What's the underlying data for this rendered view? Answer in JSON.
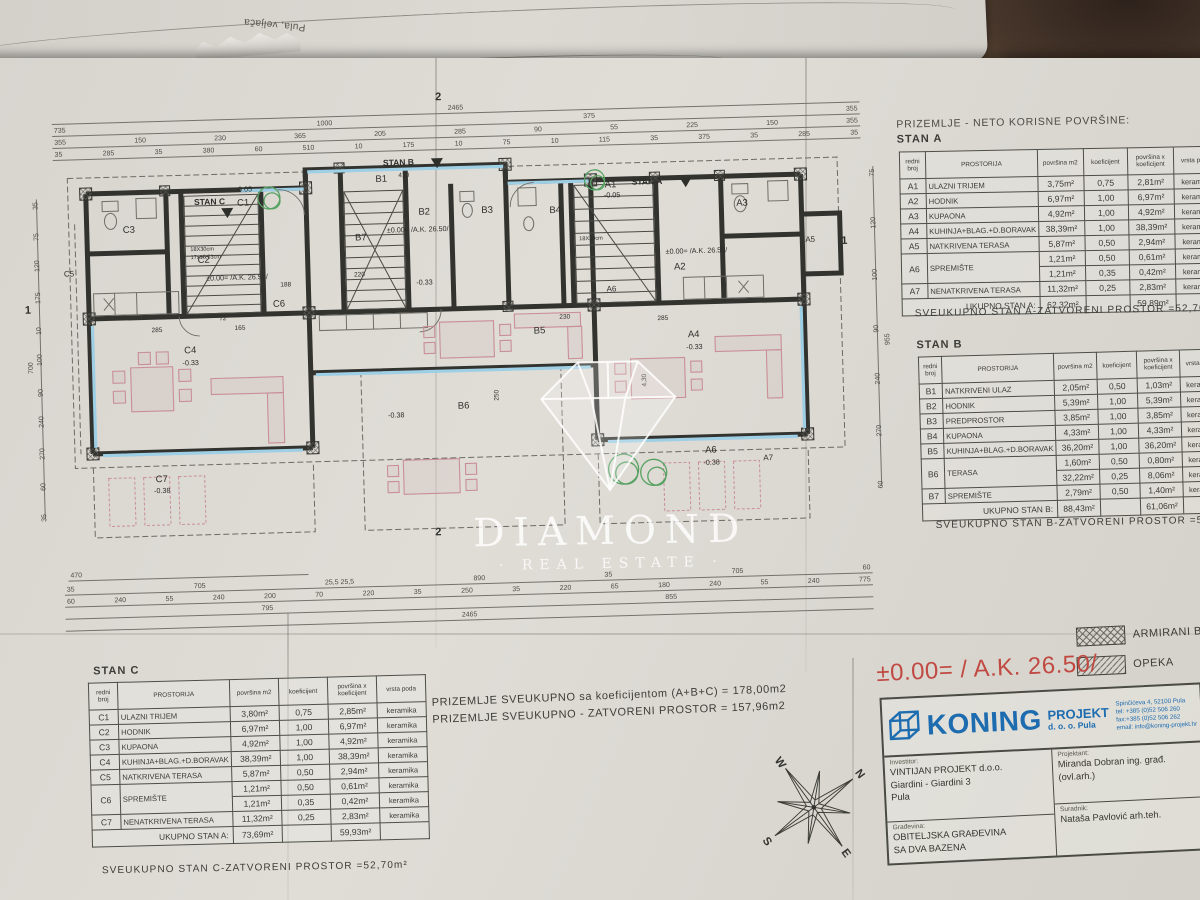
{
  "photo": {
    "back_sheet_note": "Pula, veljača"
  },
  "watermark": {
    "title": "DIAMOND",
    "subtitle": "· REAL ESTATE ·"
  },
  "plan": {
    "marker_top": "2",
    "marker_bottom": "2",
    "marker_left": "1",
    "marker_right": "1",
    "stan_a": "STAN A",
    "stan_b": "STAN B",
    "stan_c": "STAN C",
    "rooms": {
      "a1": "A1",
      "a2": "A2",
      "a3": "A3",
      "a4": "A4",
      "a5": "A5",
      "a6": "A6",
      "a6b": "A6",
      "a7": "A7",
      "b1": "B1",
      "b2": "B2",
      "b3": "B3",
      "b4": "B4",
      "b5": "B5",
      "b6": "B6",
      "b7": "B7",
      "c1": "C1",
      "c2": "C2",
      "c3": "C3",
      "c4": "C4",
      "c5": "C5",
      "c6": "C6",
      "c7": "C7"
    },
    "elev": {
      "zero": "±0.00= /A.K. 26.50/",
      "m005": "-0.05",
      "m033": "-0.33",
      "m038": "-0.38"
    },
    "stair_note": "18X30cm",
    "stair_note2": "17x15,53cm",
    "inline": {
      "d285a": "285",
      "d165": "165",
      "d230": "230",
      "d285b": "285",
      "d410": "410",
      "d220": "220",
      "d250": "250",
      "d430": "4,30",
      "d188": "188",
      "d72": "72"
    },
    "dims": {
      "top": [
        [
          "2465"
        ],
        [
          "735",
          "1000",
          "375",
          "355"
        ],
        [
          "355",
          "150",
          "230",
          "365",
          "205",
          "285",
          "90",
          "55",
          "225",
          "150",
          "355"
        ],
        [
          "35",
          "285",
          "35",
          "380",
          "60",
          "510",
          "10",
          "175",
          "10",
          "75",
          "10",
          "115",
          "35",
          "375",
          "35",
          "285",
          "35"
        ]
      ],
      "bottom": [
        [
          "470"
        ],
        [
          "35",
          "705",
          "25,5 25,5",
          "890",
          "35",
          "705",
          "60"
        ],
        [
          "60",
          "240",
          "55",
          "240",
          "200",
          "70",
          "220",
          "35",
          "250",
          "35",
          "220",
          "65",
          "180",
          "240",
          "55",
          "240",
          "775"
        ],
        [
          "795",
          "855"
        ],
        [
          "2465"
        ]
      ],
      "left": [
        "35",
        "75",
        "120",
        "175",
        "10",
        "100",
        "90",
        "240",
        "270",
        "60",
        "35"
      ],
      "left_outer": "700",
      "right": [
        "75",
        "120",
        "100",
        "90",
        "240",
        "270",
        "60"
      ],
      "right_outer": "955"
    }
  },
  "summary": {
    "line1": "PRIZEMLJE SVEUKUPNO sa koeficijentom (A+B+C) = 178,00m2",
    "line2": "PRIZEMLJE SVEUKUPNO - ZATVORENI PROSTOR = 157,96m2"
  },
  "tables": {
    "heading": "PRIZEMLJE - NETO KORISNE POVRŠINE:",
    "headers": [
      "redni broj",
      "PROSTORIJA",
      "površina m2",
      "koeficijent",
      "površina x koeficijent",
      "vrsta poda"
    ],
    "stan_a": {
      "title": "STAN A",
      "rows": [
        {
          "id": "A1",
          "name": "ULAZNI TRIJEM",
          "vals": [
            "3,75m²",
            "0,75",
            "2,81m²",
            "keramika"
          ]
        },
        {
          "id": "A2",
          "name": "HODNIK",
          "vals": [
            "6,97m²",
            "1,00",
            "6,97m²",
            "keramika"
          ]
        },
        {
          "id": "A3",
          "name": "KUPAONA",
          "vals": [
            "4,92m²",
            "1,00",
            "4,92m²",
            "keramika"
          ]
        },
        {
          "id": "A4",
          "name": "KUHINJA+BLAG.+D.BORAVAK",
          "vals": [
            "38,39m²",
            "1,00",
            "38,39m²",
            "keramika"
          ]
        },
        {
          "id": "A5",
          "name": "NATKRIVENA TERASA",
          "vals": [
            "5,87m²",
            "0,50",
            "2,94m²",
            "keramika"
          ]
        },
        {
          "id": "A6",
          "name": "SPREMIŠTE",
          "rs": 2,
          "vals": [
            "1,21m²",
            "0,50",
            "0,61m²",
            "keramika"
          ]
        },
        {
          "cont": true,
          "vals": [
            "1,21m²",
            "0,35",
            "0,42m²",
            "keramika"
          ]
        },
        {
          "id": "A7",
          "name": "NENATKRIVENA TERASA",
          "vals": [
            "11,32m²",
            "0,25",
            "2,83m²",
            "keramika"
          ]
        }
      ],
      "total_label": "UKUPNO STAN A:",
      "total_pov": "62,32m²",
      "total_povk": "59,89m²",
      "note": "SVEUKUPNO STAN A-ZATVORENI PROSTOR =52,70m²"
    },
    "stan_b": {
      "title": "STAN B",
      "rows": [
        {
          "id": "B1",
          "name": "NATKRIVENI ULAZ",
          "vals": [
            "2,05m²",
            "0,50",
            "1,03m²",
            "keramika"
          ]
        },
        {
          "id": "B2",
          "name": "HODNIK",
          "vals": [
            "5,39m²",
            "1,00",
            "5,39m²",
            "keramika"
          ]
        },
        {
          "id": "B3",
          "name": "PREDPROSTOR",
          "vals": [
            "3,85m²",
            "1,00",
            "3,85m²",
            "keramika"
          ]
        },
        {
          "id": "B4",
          "name": "KUPAONA",
          "vals": [
            "4,33m²",
            "1,00",
            "4,33m²",
            "keramika"
          ]
        },
        {
          "id": "B5",
          "name": "KUHINJA+BLAG.+D.BORAVAK",
          "vals": [
            "36,20m²",
            "1,00",
            "36,20m²",
            "keramika"
          ]
        },
        {
          "id": "B6",
          "name": "TERASA",
          "rs": 2,
          "vals": [
            "1,60m²",
            "0,50",
            "0,80m²",
            "keramika"
          ]
        },
        {
          "cont": true,
          "vals": [
            "32,22m²",
            "0,25",
            "8,06m²",
            "keramika"
          ]
        },
        {
          "id": "B7",
          "name": "SPREMIŠTE",
          "vals": [
            "2,79m²",
            "0,50",
            "1,40m²",
            "keramika"
          ]
        }
      ],
      "total_label": "UKUPNO STAN B:",
      "total_pov": "88,43m²",
      "total_povk": "61,06m²",
      "note": "SVEUKUPNO STAN B-ZATVORENI PROSTOR =52,56m²"
    },
    "stan_c": {
      "title": "STAN C",
      "rows": [
        {
          "id": "C1",
          "name": "ULAZNI TRIJEM",
          "vals": [
            "3,80m²",
            "0,75",
            "2,85m²",
            "keramika"
          ]
        },
        {
          "id": "C2",
          "name": "HODNIK",
          "vals": [
            "6,97m²",
            "1,00",
            "6,97m²",
            "keramika"
          ]
        },
        {
          "id": "C3",
          "name": "KUPAONA",
          "vals": [
            "4,92m²",
            "1,00",
            "4,92m²",
            "keramika"
          ]
        },
        {
          "id": "C4",
          "name": "KUHINJA+BLAG.+D.BORAVAK",
          "vals": [
            "38,39m²",
            "1,00",
            "38,39m²",
            "keramika"
          ]
        },
        {
          "id": "C5",
          "name": "NATKRIVENA TERASA",
          "vals": [
            "5,87m²",
            "0,50",
            "2,94m²",
            "keramika"
          ]
        },
        {
          "id": "C6",
          "name": "SPREMIŠTE",
          "rs": 2,
          "vals": [
            "1,21m²",
            "0,50",
            "0,61m²",
            "keramika"
          ]
        },
        {
          "cont": true,
          "vals": [
            "1,21m²",
            "0,35",
            "0,42m²",
            "keramika"
          ]
        },
        {
          "id": "C7",
          "name": "NENATKRIVENA TERASA",
          "vals": [
            "11,32m²",
            "0,25",
            "2,83m²",
            "keramika"
          ]
        }
      ],
      "total_label": "UKUPNO STAN A:",
      "total_pov": "73,69m²",
      "total_povk": "59,93m²",
      "note": "SVEUKUPNO STAN C-ZATVORENI PROSTOR =52,70m²"
    }
  },
  "legend": {
    "armirani_label": "ARMIRANI B",
    "opeka_label": "OPEKA",
    "elevation_note": "±0.00= / A.K. 26.50/"
  },
  "titleblock": {
    "company_name": "KONING",
    "company_name2": "PROJEKT",
    "company_name3": "d. o. o. Pula",
    "addr1": "Spinčićeva 4, 52100 Pula",
    "addr2": "tel: +385 (0)52 506 260",
    "addr3": "fax:+385 (0)52 506 262",
    "addr4": "email: info@koning-projekt.hr",
    "investor_label": "Investitor:",
    "investor_line1": "VINTIJAN PROJEKT d.o.o.",
    "investor_line2": "Giardini - Giardini 3",
    "investor_line3": "Pula",
    "designer_label": "Projektant:",
    "designer": "Miranda Dobran ing. građ. (ovl.arh.)",
    "building_label": "Građevina:",
    "building_line1": "OBITELJSKA GRAĐEVINA",
    "building_line2": "SA DVA BAZENA",
    "collab_label": "Suradnik:",
    "collab": "Nataša Pavlović arh.teh."
  },
  "compass": {
    "n": "N",
    "s": "S",
    "e": "E",
    "w": "W"
  }
}
